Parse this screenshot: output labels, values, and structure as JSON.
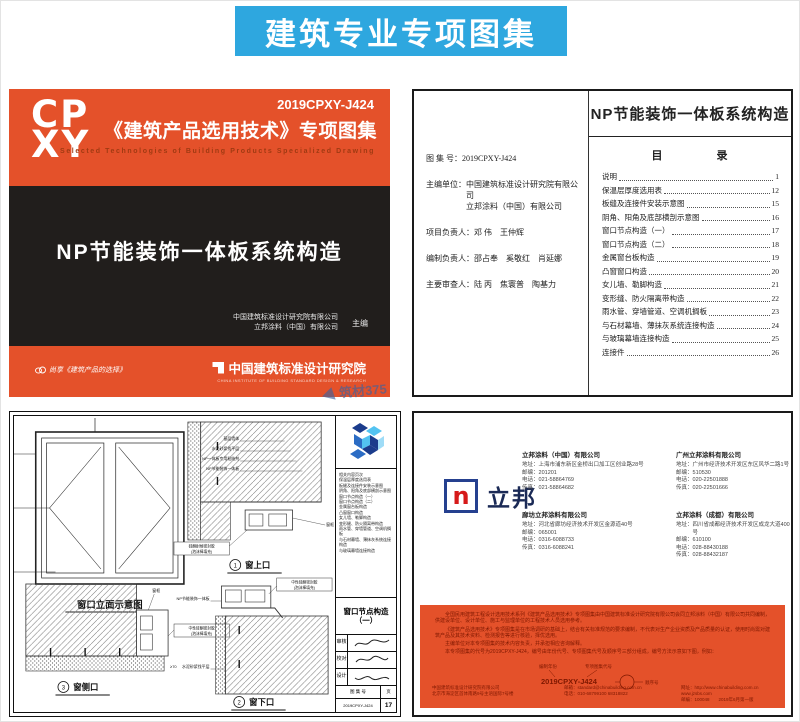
{
  "banner": {
    "title": "建筑专业专项图集",
    "bg": "#2EA7DF"
  },
  "cover": {
    "logo_line1": "CP",
    "logo_line2": "XY",
    "code": "2019CPXY-J424",
    "series_title": "《建筑产品选用技术》专项图集",
    "series_subtitle": "Selected Technologies of Building Products Specialized Drawing",
    "main_title": "NP节能装饰一体板系统构造",
    "editor1": "中国建筑标准设计研究院有限公司",
    "editor2": "立邦涂料（中国）有限公司",
    "editor_role": "主编",
    "footer_left": "尚享《建筑产品的选择》",
    "footer_right": "中国建筑标准设计研究院",
    "footer_right_sub": "CHINA INSTITUTE OF BUILDING STANDARD DESIGN & RESEARCH",
    "watermark": "筑材375",
    "orange": "#E4512A",
    "black": "#211E1C"
  },
  "toc": {
    "title": "NP节能装饰一体板系统构造",
    "fields": [
      {
        "label": "图 集 号：",
        "value": "2019CPXY-J424"
      },
      {
        "label": "主编单位：",
        "value": "中国建筑标准设计研究院有限公司\n立邦涂料（中国）有限公司"
      },
      {
        "label": "项目负责人：",
        "value": "邓  伟　王仲辉"
      },
      {
        "label": "编制负责人：",
        "value": "邵占奉　奚敬红　肖延娜"
      },
      {
        "label": "主要审查人：",
        "value": "陆  丙　焦寰普　陶基力"
      }
    ],
    "directory_title": "目　　　　录",
    "entries": [
      {
        "label": "说明",
        "page": "1"
      },
      {
        "label": "保温层厚度选用表",
        "page": "12"
      },
      {
        "label": "板缝及连接件安装示意图",
        "page": "15"
      },
      {
        "label": "阴角、阳角及底部横剖示意图",
        "page": "16"
      },
      {
        "label": "窗口节点构造（一）",
        "page": "17"
      },
      {
        "label": "窗口节点构造（二）",
        "page": "18"
      },
      {
        "label": "金属窗台板构造",
        "page": "19"
      },
      {
        "label": "凸窗窗口构造",
        "page": "20"
      },
      {
        "label": "女儿墙、勒脚构造",
        "page": "21"
      },
      {
        "label": "变形缝、防火隔离带构造",
        "page": "22"
      },
      {
        "label": "雨水管、穿墙管道、空调机搁板",
        "page": "23"
      },
      {
        "label": "与石材幕墙、薄抹灰系统连接构造",
        "page": "24"
      },
      {
        "label": "与玻璃幕墙连接构造",
        "page": "25"
      },
      {
        "label": "连接件",
        "page": "26"
      }
    ]
  },
  "draw": {
    "elevation_caption": "窗口立面示意图",
    "details": [
      {
        "num": "1",
        "name": "窗上口"
      },
      {
        "num": "2",
        "name": "窗下口"
      },
      {
        "num": "3",
        "name": "窗侧口"
      }
    ],
    "leaders": {
      "l1": "基层墙体",
      "l2": "水泥砂浆找平层",
      "l3": "NP一体板专用粘结剂",
      "l4": "NP节能装饰一体板",
      "weather_l1": "硅酮耐候密封胶",
      "weather_l2": "(泡沫棒填充)",
      "seal_l1": "中性硅酮密封胶",
      "seal_l2": "(泡沫棒填充)",
      "frame": "窗框",
      "dim": "≥70"
    },
    "side": {
      "index": "相关内容页次\n保温层厚度选用表\n板缝及连接件安装示意图\n阴角、阳角及底部横剖示意图\n窗口节点构造（一）\n窗口节点构造（二）\n金属窗台板构造\n凸窗窗口构造\n女儿墙、勒脚构造\n变形缝、防火隔离带构造\n雨水管、穿墙管道、空调机搁板\n与石材幕墙、薄抹灰系统连接构造\n与玻璃幕墙连接构造",
      "title": "窗口节点构造\n（一）",
      "sigs": [
        {
          "role": "审核"
        },
        {
          "role": "校对"
        },
        {
          "role": "设计"
        }
      ],
      "atlas_label": "图 集 号",
      "page_label": "页",
      "atlas_no": "2019CPXY-J424",
      "page_no": "17"
    }
  },
  "pub": {
    "brand": "立邦",
    "brand_letter": "n",
    "labels": {
      "addr": "地址：",
      "zip": "邮编：",
      "tel": "电话：",
      "fax": "传真："
    },
    "companies": [
      {
        "name": "立邦涂料（中国）有限公司",
        "address": "上海市浦东新区金桥出口加工区创业路28号",
        "zip": "201201",
        "tel": "021-58864769",
        "fax": "021-58864682"
      },
      {
        "name": "广州立邦涂料有限公司",
        "address": "广州市经济技术开发区东区风华二路1号",
        "zip": "510530",
        "tel": "020-22501888",
        "fax": "020-22501666"
      },
      {
        "name": "廊坊立邦涂料有限公司",
        "address": "河北省廊坊经济技术开发区金源道40号",
        "zip": "065001",
        "tel": "0316-6088733",
        "fax": "0316-6088241"
      },
      {
        "name": "立邦涂料（成都）有限公司",
        "address": "四川省成都经济技术开发区成龙大道400号",
        "zip": "610100",
        "tel": "028-88430188",
        "fax": "028-88432187"
      }
    ],
    "back": {
      "p1": "全国民用建筑工程设计选用技术系列《建筑产品选用技术》专项图集由中国建筑标准设计研究院有限公司会同立邦涂料（中国）有限公司共同编制，供建设单位、设计单位、施工与监理单位的工程技术人员选用参考。",
      "p2": "《建筑产品选用技术》专项图集是在市场调研的基础上，结合有关标准规范的要求编制，不代表对生产企业资质及产品质量的认证，使用时尚需对建筑产品及其技术资料、检测报告等进行核验，择优选用。",
      "p3": "主编单位对本专项图集的技术内容负责，并承担相应咨询解释。",
      "p4": "本专项图集的代号为2019CPXY-J424，编号由年份代号、专项图集代号及顺序号三部分组成，编号方法示意如下图，例如：",
      "diagram": {
        "code": "2019CPXY-J424",
        "labels": [
          "编制年份",
          "专项图集代号",
          "顺序号"
        ]
      },
      "footer": [
        "中国建筑标准设计研究院有限公司\n北京市海淀区首体南路9号主语国际7号楼",
        "邮箱：standard@chinabuilding.com.cn\n电话：010-68799100  68318822",
        "网址：http://www.chinabuilding.com.cn  www.jzsbs.com\n邮编：100048　　2019年6月第一版"
      ]
    }
  }
}
